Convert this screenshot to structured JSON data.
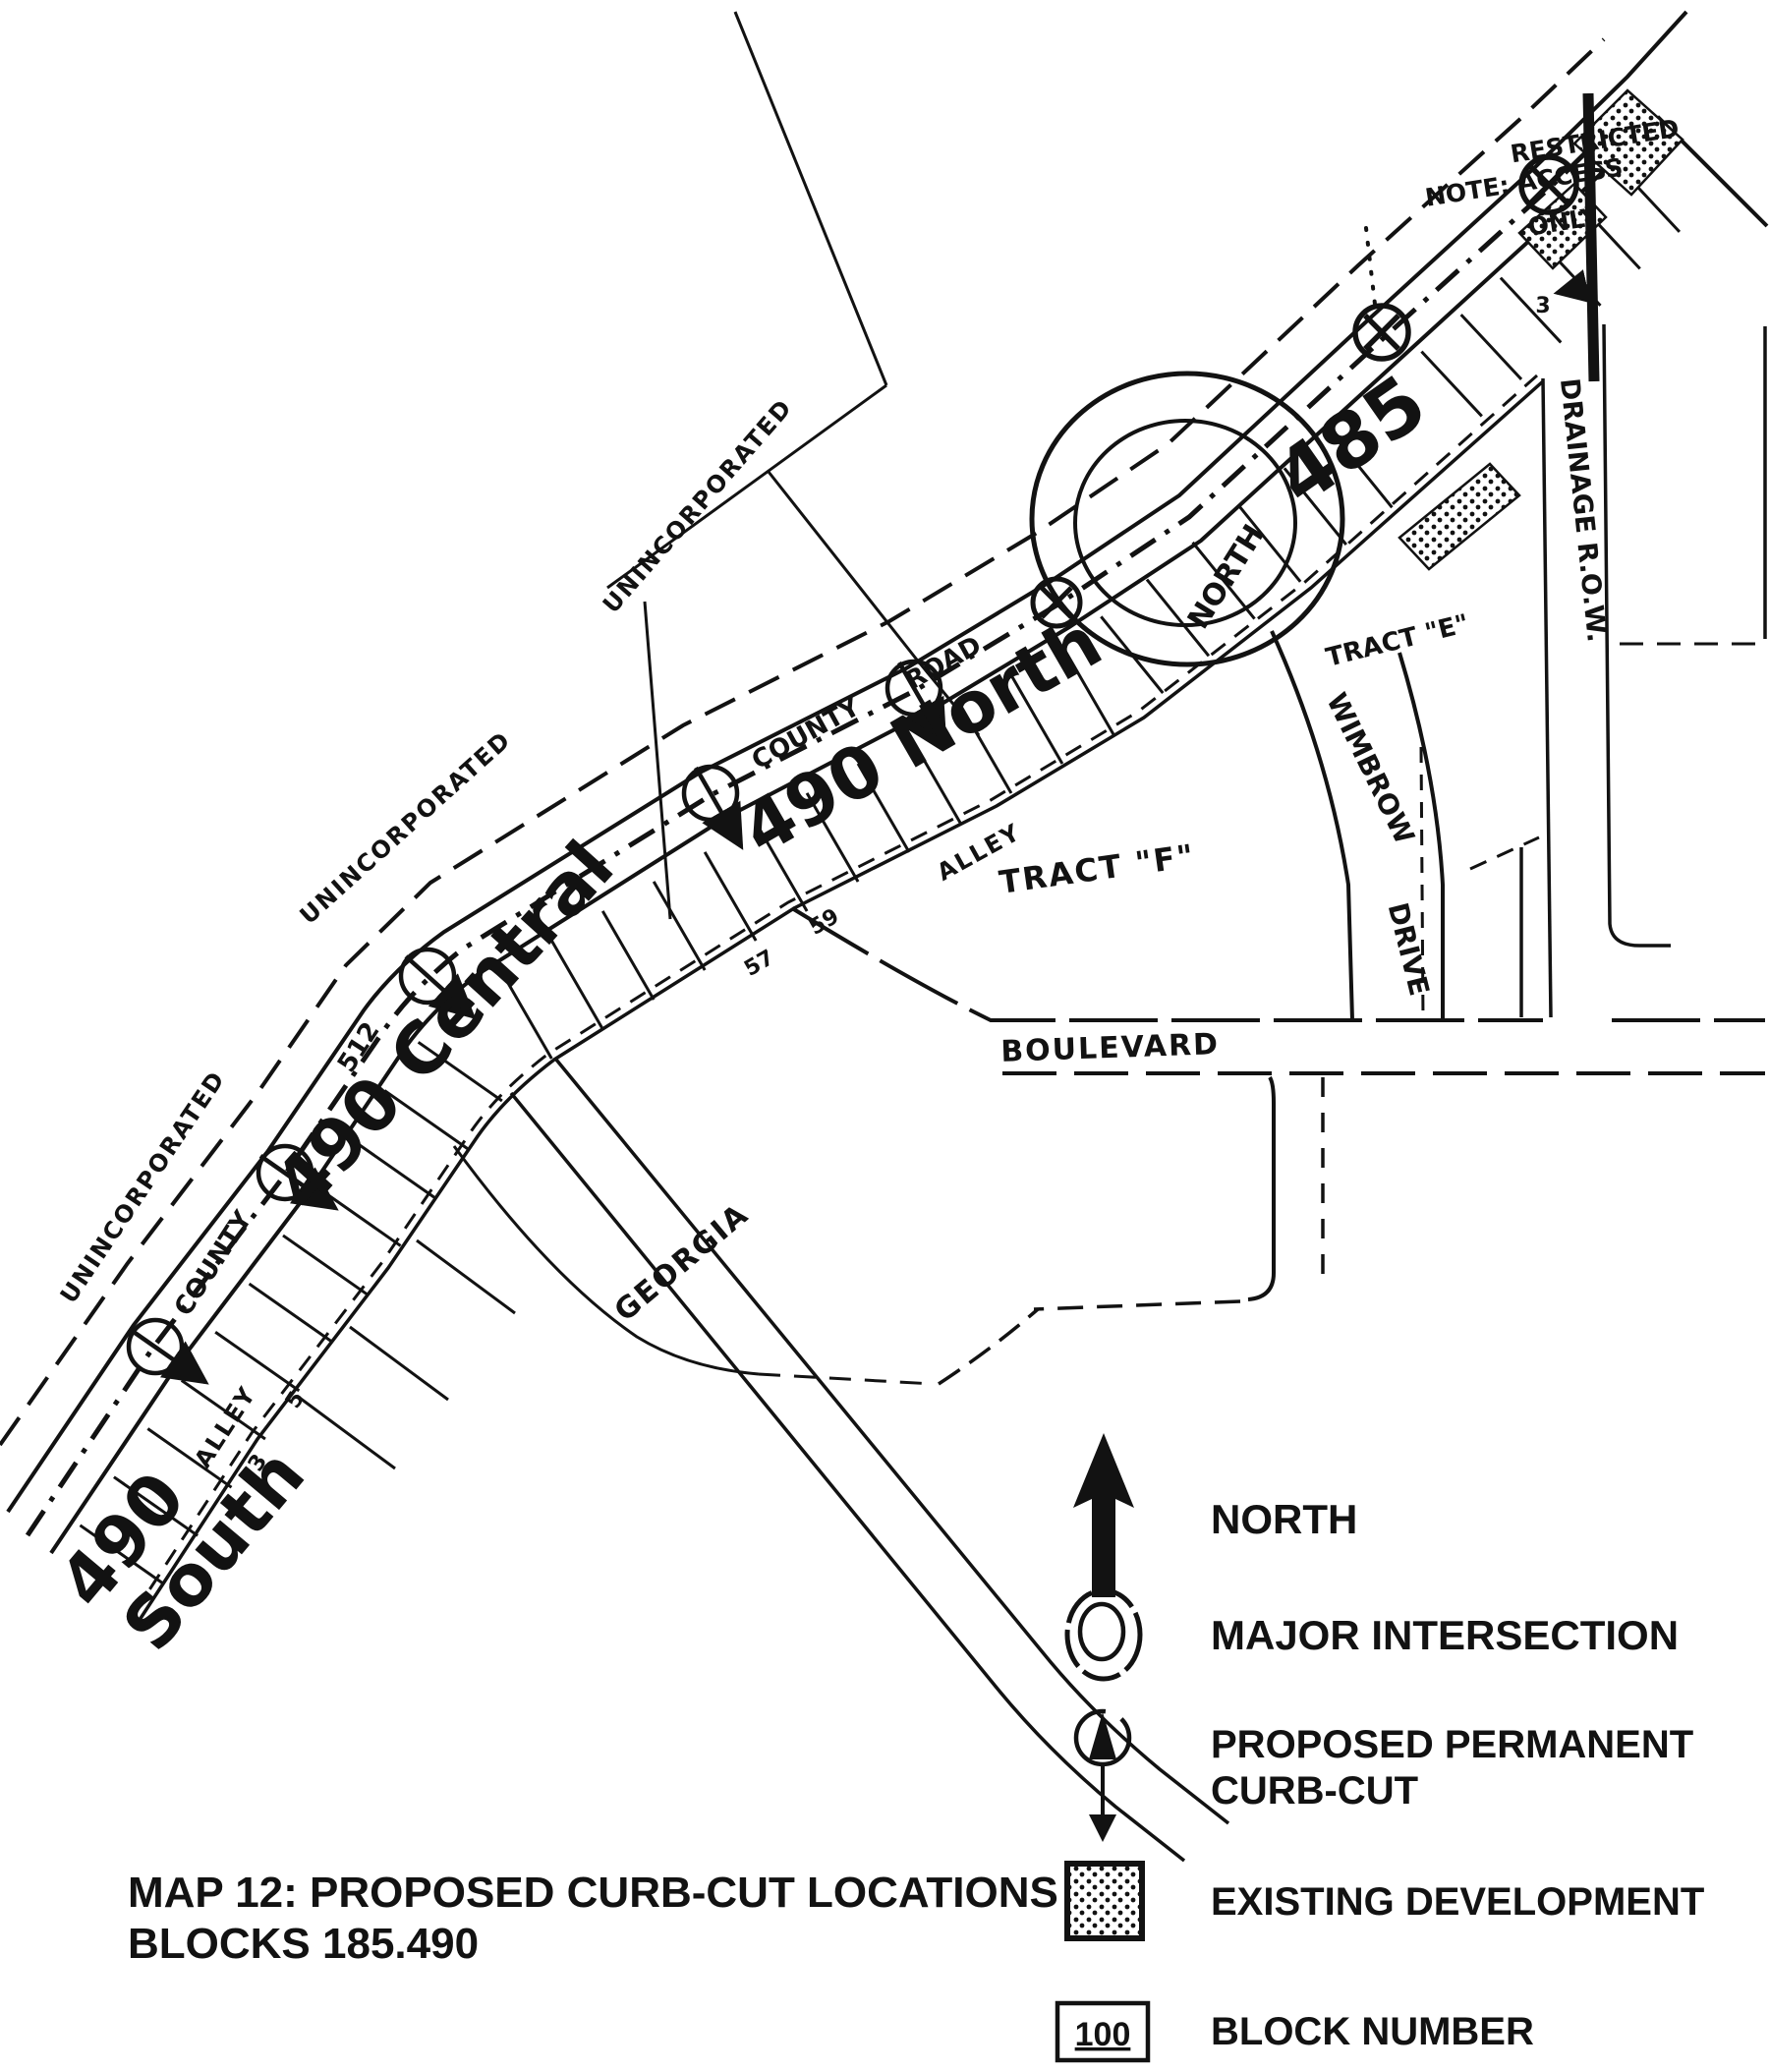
{
  "colors": {
    "paper": "#ffffff",
    "ink": "#121212"
  },
  "title": {
    "line1": "MAP 12:  PROPOSED CURB-CUT LOCATIONS",
    "line2": "BLOCKS 185.490"
  },
  "legend": {
    "north": "NORTH",
    "major_intersection": "MAJOR INTERSECTION",
    "curb_cut_line1": "PROPOSED PERMANENT",
    "curb_cut_line2": "CURB-CUT",
    "existing_development": "EXISTING DEVELOPMENT",
    "block_number": "BLOCK NUMBER",
    "block_number_sample": "100"
  },
  "map": {
    "blocks": {
      "b485": "485",
      "b490_north": "490 North",
      "b490_central": "490 Central",
      "b490_south_line1": "490",
      "b490_south_line2": "South"
    },
    "streets": {
      "county": "COUNTY",
      "road": "ROAD",
      "route_512": "512",
      "alley": "ALLEY",
      "boulevard": "BOULEVARD",
      "georgia": "GEORGIA",
      "wimbrow": "WIMBROW",
      "drive": "DRIVE",
      "drainage_row": "DRAINAGE R.O.W.",
      "north_small": "NORTH"
    },
    "areas": {
      "unincorporated": "UNINCORPORATED",
      "tract_f": "TRACT \"F\"",
      "tract_e": "TRACT \"E\""
    },
    "note": {
      "line1": "RESTRICTED",
      "line2": "NOTE: ACCESS",
      "line3": "ONLY"
    },
    "lot_numbers": {
      "n57": "57",
      "n59": "59",
      "n5": "5",
      "n3": "3",
      "n3b": "3"
    }
  }
}
